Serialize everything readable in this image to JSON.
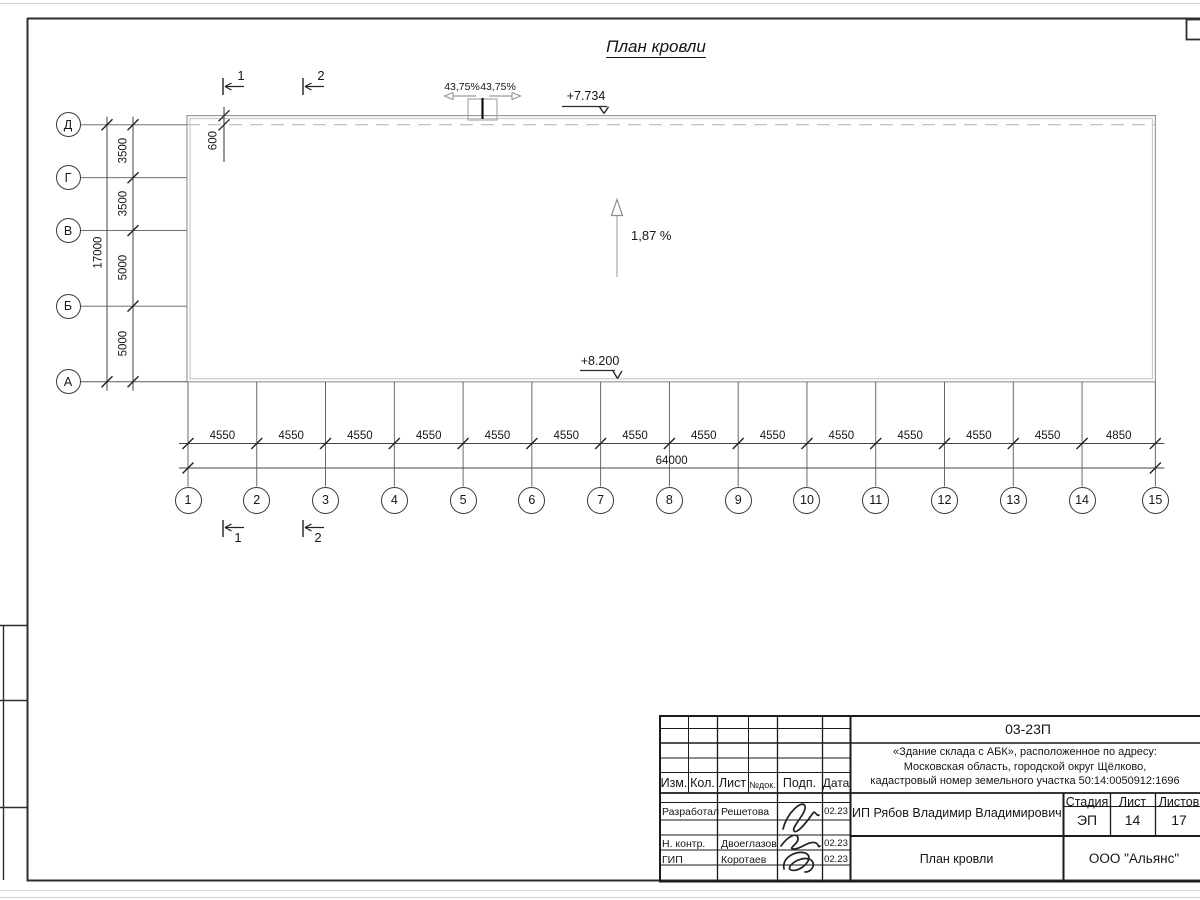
{
  "drawing": {
    "title": "План кровли",
    "elevation_top": "+7.734",
    "elevation_bottom": "+8.200",
    "slope_label": "1,87 %",
    "slope_left": "43,75%",
    "slope_right": "43,75%",
    "parapet_offset": "600"
  },
  "axes": {
    "horizontal": [
      "1",
      "2",
      "3",
      "4",
      "5",
      "6",
      "7",
      "8",
      "9",
      "10",
      "11",
      "12",
      "13",
      "14",
      "15"
    ],
    "vertical": [
      "Д",
      "Г",
      "В",
      "Б",
      "А"
    ],
    "section_marks": [
      "1",
      "2"
    ]
  },
  "dimensions": {
    "bottom_segments": [
      "4550",
      "4550",
      "4550",
      "4550",
      "4550",
      "4550",
      "4550",
      "4550",
      "4550",
      "4550",
      "4550",
      "4550",
      "4550",
      "4850"
    ],
    "bottom_total": "64000",
    "left_segments": [
      "3500",
      "3500",
      "5000",
      "5000"
    ],
    "left_total": "17000"
  },
  "title_block": {
    "doc_number": "03-23П",
    "project_address": [
      "«Здание склада с АБК», расположенное по адресу:",
      "Московская область, городской округ Щёлково,",
      "кадастровый номер земельного участка 50:14:0050912:1696"
    ],
    "client": "ИП Рябов Владимир Владимирович",
    "sheet_title": "План кровли",
    "company": "ООО \"Альянс\"",
    "columns": [
      "Изм.",
      "Кол.",
      "Лист",
      "№док.",
      "Подп.",
      "Дата"
    ],
    "stage_header": "Стадия",
    "sheet_header": "Лист",
    "sheets_header": "Листов",
    "stage": "ЭП",
    "sheet": "14",
    "sheets": "17",
    "signers": [
      {
        "role": "Разработал",
        "name": "Решетова",
        "date": "02.23"
      },
      {
        "role": "Н. контр.",
        "name": "Двоеглазов",
        "date": "02.23"
      },
      {
        "role": "ГИП",
        "name": "Коротаев",
        "date": "02.23"
      }
    ]
  },
  "colors": {
    "ink": "#1a1a1a",
    "light_line": "#9a9a9a"
  }
}
